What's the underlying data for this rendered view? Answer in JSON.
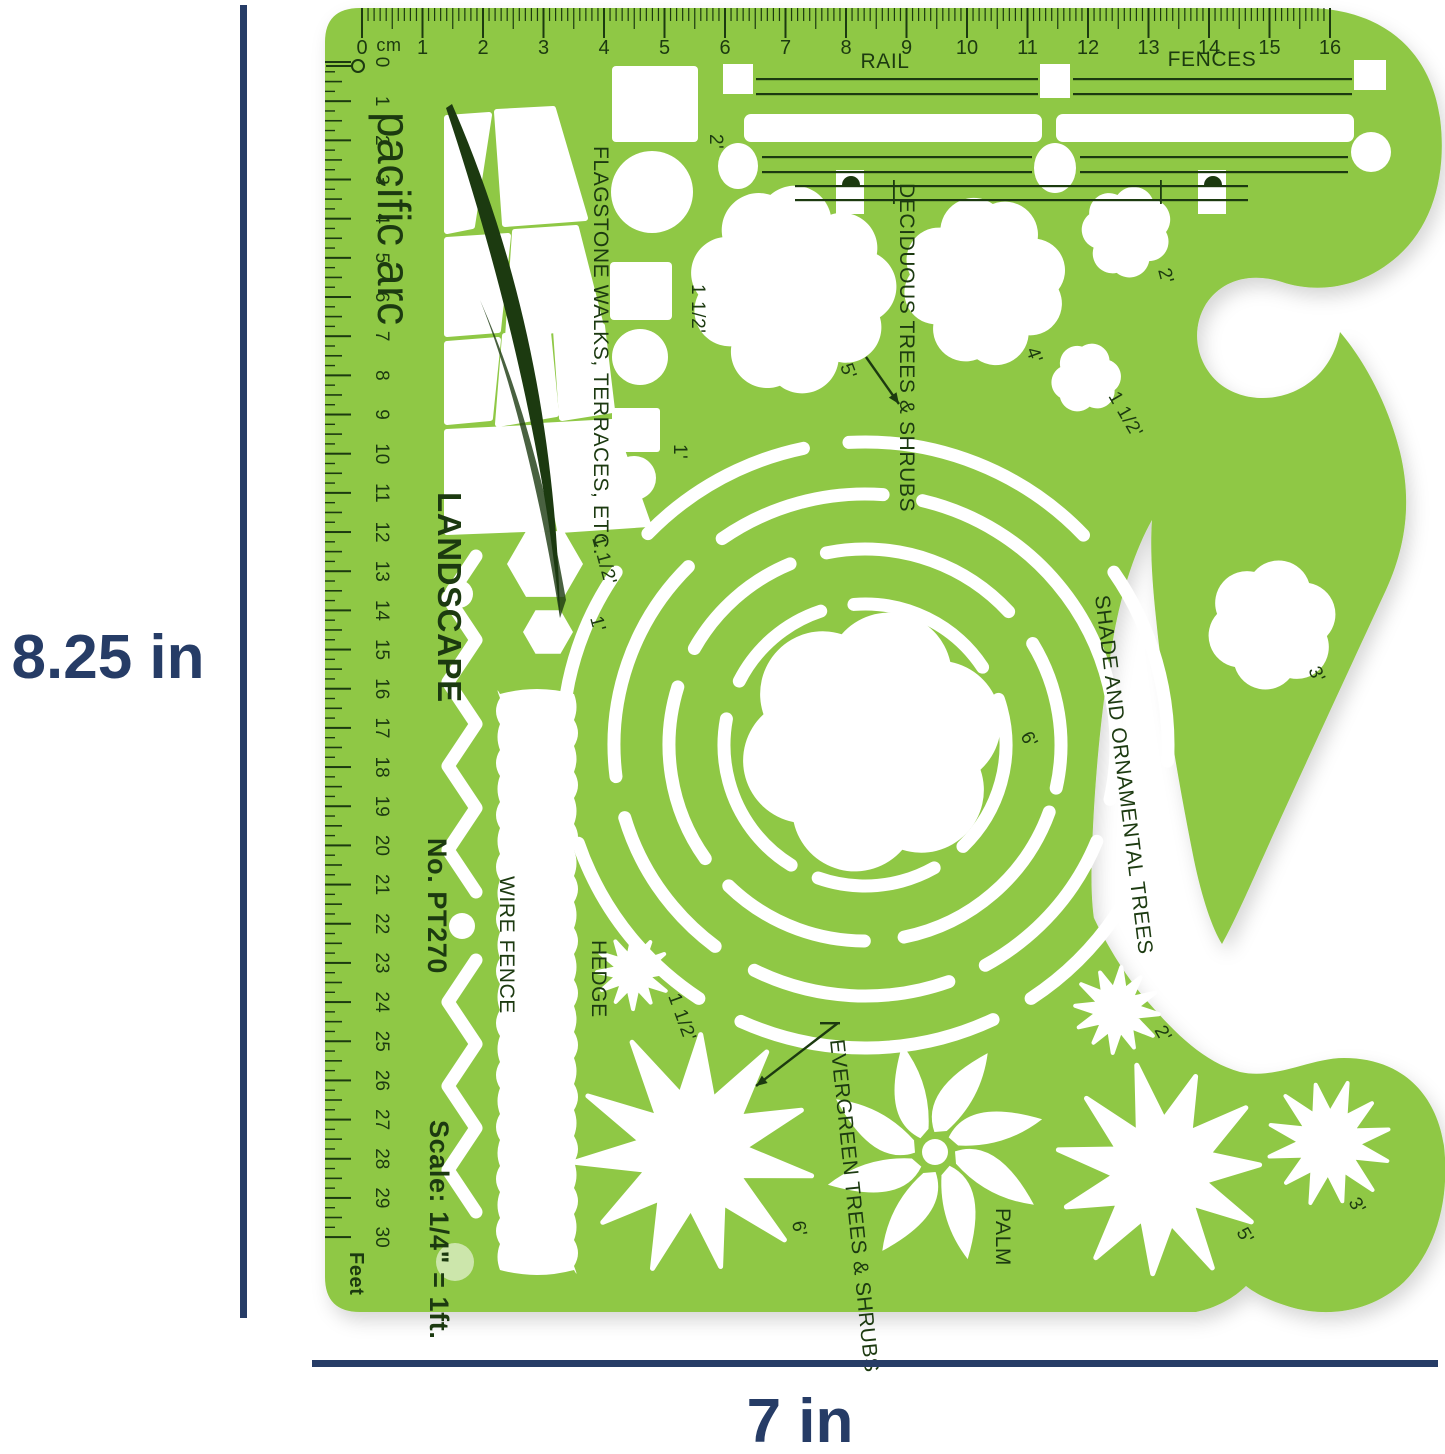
{
  "dimensions": {
    "height": "8.25 in",
    "width": "7 in"
  },
  "brand": {
    "logo": "pacific arc",
    "series": "LANDSCAPE",
    "model_no": "No. PT270",
    "scale_note": "Scale: 1/4\" = 1ft."
  },
  "rulers": {
    "top_unit": "cm",
    "top_numbers": [
      "0",
      "1",
      "2",
      "3",
      "4",
      "5",
      "6",
      "7",
      "8",
      "9",
      "10",
      "11",
      "12",
      "13",
      "14",
      "15",
      "16"
    ],
    "left_numbers": [
      "0",
      "1",
      "2",
      "3",
      "4",
      "5",
      "6",
      "7",
      "8",
      "9",
      "10",
      "11",
      "12",
      "13",
      "14",
      "15",
      "16",
      "17",
      "18",
      "19",
      "20",
      "21",
      "22",
      "23",
      "24",
      "25",
      "26",
      "27",
      "28",
      "29",
      "30"
    ],
    "left_unit": "Feet"
  },
  "labels": {
    "rail": "RAIL",
    "fences": "FENCES",
    "flagstone": "FLAGSTONE WALKS, TERRACES, ETC.",
    "deciduous": "DECIDUOUS TREES & SHRUBS",
    "shade": "SHADE AND ORNAMENTAL TREES",
    "evergreen": "EVERGREEN TREES & SHRUBS",
    "wire_fence": "WIRE FENCE",
    "hedge": "HEDGE",
    "palm": "PALM"
  },
  "size_labels": {
    "flagstone_square": "2'",
    "flagstone_mid": "1 1/2'",
    "flagstone_small": "1'",
    "hex_large": "1 1/2'",
    "hex_small": "1'",
    "deciduous_large": "5'",
    "deciduous_medium": "4'",
    "deciduous_small": "2'",
    "deciduous_tiny": "1 1/2'",
    "shade_center": "6'",
    "shade_right": "3'",
    "hedge_star": "1 1/2'",
    "evergreen_large": "6'",
    "evergreen_small": "2'",
    "evergreen_medium": "5'",
    "evergreen_tiny": "3'"
  },
  "colors": {
    "template_green": "#8fc845",
    "print_dark": "#1c3a10",
    "dimension_navy": "#263c66",
    "background": "#ffffff"
  }
}
